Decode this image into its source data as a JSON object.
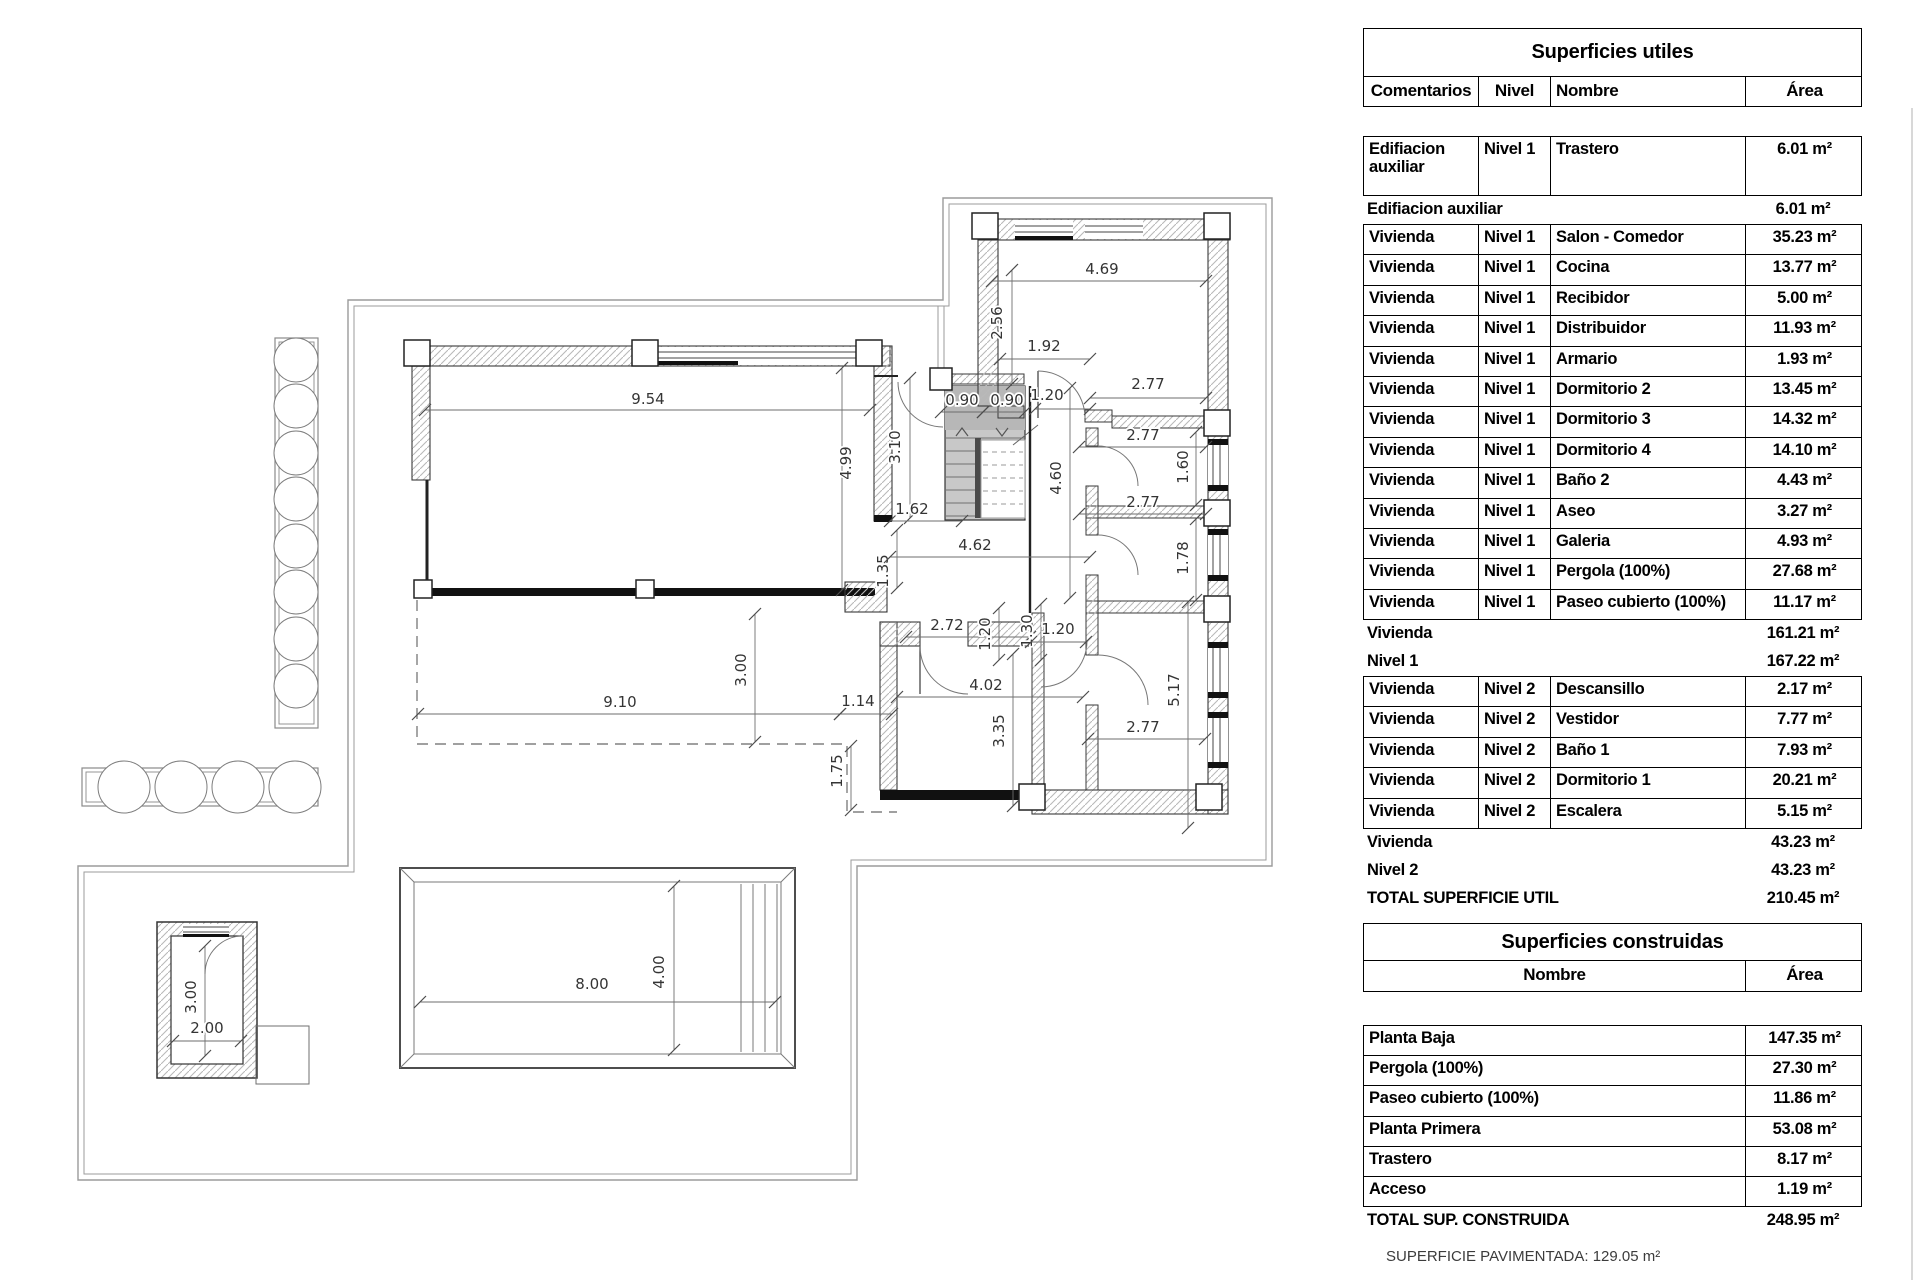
{
  "plan": {
    "footer_note": "SUPERFICIE PAVIMENTADA: 129.05 m²",
    "dimensions": [
      [
        "9.54",
        425,
        410,
        870,
        410,
        648,
        404,
        0
      ],
      [
        "4.99",
        842,
        368,
        842,
        590,
        851,
        463,
        1
      ],
      [
        "3.10",
        910,
        378,
        910,
        518,
        900,
        447,
        1
      ],
      [
        "1.62",
        890,
        521,
        962,
        521,
        912,
        514,
        0
      ],
      [
        "1.35",
        897,
        530,
        897,
        588,
        888,
        571,
        1
      ],
      [
        "4.62",
        890,
        557,
        1090,
        557,
        975,
        550,
        0
      ],
      [
        "0.90",
        941,
        412,
        983,
        412,
        962,
        405,
        0
      ],
      [
        "0.90",
        983,
        412,
        1025,
        412,
        1007,
        405,
        0
      ],
      [
        "1.20",
        1035,
        409,
        1090,
        409,
        1047,
        400,
        0
      ],
      [
        "2.56",
        1012,
        270,
        1012,
        384,
        1002,
        323,
        1
      ],
      [
        "1.92",
        1000,
        359,
        1090,
        359,
        1044,
        351,
        0
      ],
      [
        "4.69",
        992,
        281,
        1206,
        281,
        1102,
        274,
        0
      ],
      [
        "2.77",
        1090,
        398,
        1206,
        398,
        1148,
        389,
        0
      ],
      [
        "2.77",
        1079,
        447,
        1206,
        447,
        1143,
        440,
        0
      ],
      [
        "1.60",
        1196,
        432,
        1196,
        505,
        1188,
        467,
        1
      ],
      [
        "4.60",
        1070,
        388,
        1070,
        598,
        1061,
        478,
        1
      ],
      [
        "2.77",
        1079,
        514,
        1206,
        514,
        1143,
        507,
        0
      ],
      [
        "1.78",
        1196,
        519,
        1196,
        600,
        1188,
        558,
        1
      ],
      [
        "2.72",
        906,
        637,
        1030,
        637,
        947,
        630,
        0
      ],
      [
        "1.20",
        999,
        608,
        999,
        660,
        990,
        634,
        1
      ],
      [
        "1.30",
        1041,
        604,
        1041,
        660,
        1032,
        631,
        1
      ],
      [
        "1.20",
        1031,
        642,
        1086,
        642,
        1058,
        634,
        0
      ],
      [
        "4.02",
        897,
        697,
        1083,
        697,
        986,
        690,
        0
      ],
      [
        "3.35",
        1013,
        654,
        1013,
        806,
        1004,
        731,
        1
      ],
      [
        "2.77",
        1088,
        739,
        1205,
        739,
        1143,
        732,
        0
      ],
      [
        "5.17",
        1188,
        602,
        1188,
        828,
        1179,
        690,
        1
      ],
      [
        "3.00",
        755,
        614,
        755,
        742,
        746,
        670,
        1
      ],
      [
        "9.10",
        418,
        714,
        840,
        714,
        620,
        707,
        0
      ],
      [
        "1.14",
        840,
        714,
        892,
        714,
        858,
        706,
        0
      ],
      [
        "1.75",
        851,
        746,
        851,
        810,
        842,
        771,
        1
      ],
      [
        "3.00",
        205,
        946,
        205,
        1056,
        196,
        997,
        1
      ],
      [
        "2.00",
        173,
        1041,
        241,
        1041,
        207,
        1033,
        0
      ],
      [
        "8.00",
        420,
        1002,
        775,
        1002,
        592,
        989,
        0
      ],
      [
        "4.00",
        674,
        886,
        674,
        1050,
        664,
        972,
        1
      ]
    ]
  },
  "tables": {
    "utiles": {
      "title": "Superficies utiles",
      "columns": [
        "Comentarios",
        "Nivel",
        "Nombre",
        "Área"
      ],
      "groups": [
        {
          "rows": [
            [
              "Edifiacion auxiliar",
              "Nivel 1",
              "Trastero",
              "6.01 m²"
            ]
          ],
          "subtotals": [
            [
              "Edifiacion auxiliar",
              "6.01 m²"
            ]
          ]
        },
        {
          "rows": [
            [
              "Vivienda",
              "Nivel 1",
              "Salon - Comedor",
              "35.23 m²"
            ],
            [
              "Vivienda",
              "Nivel 1",
              "Cocina",
              "13.77 m²"
            ],
            [
              "Vivienda",
              "Nivel 1",
              "Recibidor",
              "5.00 m²"
            ],
            [
              "Vivienda",
              "Nivel 1",
              "Distribuidor",
              "11.93 m²"
            ],
            [
              "Vivienda",
              "Nivel 1",
              "Armario",
              "1.93 m²"
            ],
            [
              "Vivienda",
              "Nivel 1",
              "Dormitorio 2",
              "13.45 m²"
            ],
            [
              "Vivienda",
              "Nivel 1",
              "Dormitorio 3",
              "14.32 m²"
            ],
            [
              "Vivienda",
              "Nivel 1",
              "Dormitorio 4",
              "14.10 m²"
            ],
            [
              "Vivienda",
              "Nivel 1",
              "Baño 2",
              "4.43 m²"
            ],
            [
              "Vivienda",
              "Nivel 1",
              "Aseo",
              "3.27 m²"
            ],
            [
              "Vivienda",
              "Nivel 1",
              "Galeria",
              "4.93 m²"
            ],
            [
              "Vivienda",
              "Nivel 1",
              "Pergola (100%)",
              "27.68 m²"
            ],
            [
              "Vivienda",
              "Nivel 1",
              "Paseo cubierto (100%)",
              "11.17 m²"
            ]
          ],
          "subtotals": [
            [
              "Vivienda",
              "161.21 m²"
            ],
            [
              "Nivel 1",
              "167.22 m²"
            ]
          ]
        },
        {
          "rows": [
            [
              "Vivienda",
              "Nivel 2",
              "Descansillo",
              "2.17 m²"
            ],
            [
              "Vivienda",
              "Nivel 2",
              "Vestidor",
              "7.77 m²"
            ],
            [
              "Vivienda",
              "Nivel 2",
              "Baño 1",
              "7.93 m²"
            ],
            [
              "Vivienda",
              "Nivel 2",
              "Dormitorio 1",
              "20.21 m²"
            ],
            [
              "Vivienda",
              "Nivel 2",
              "Escalera",
              "5.15 m²"
            ]
          ],
          "subtotals": [
            [
              "Vivienda",
              "43.23 m²"
            ],
            [
              "Nivel 2",
              "43.23 m²"
            ],
            [
              "TOTAL SUPERFICIE UTIL",
              "210.45 m²"
            ]
          ]
        }
      ]
    },
    "construidas": {
      "title": "Superficies construidas",
      "columns": [
        "Nombre",
        "Área"
      ],
      "rows": [
        [
          "Planta Baja",
          "147.35 m²"
        ],
        [
          "Pergola (100%)",
          "27.30 m²"
        ],
        [
          "Paseo cubierto (100%)",
          "11.86 m²"
        ],
        [
          "Planta Primera",
          "53.08 m²"
        ],
        [
          "Trastero",
          "8.17 m²"
        ],
        [
          "Acceso",
          "1.19 m²"
        ]
      ],
      "total": [
        "TOTAL SUP. CONSTRUIDA",
        "248.95 m²"
      ]
    }
  }
}
